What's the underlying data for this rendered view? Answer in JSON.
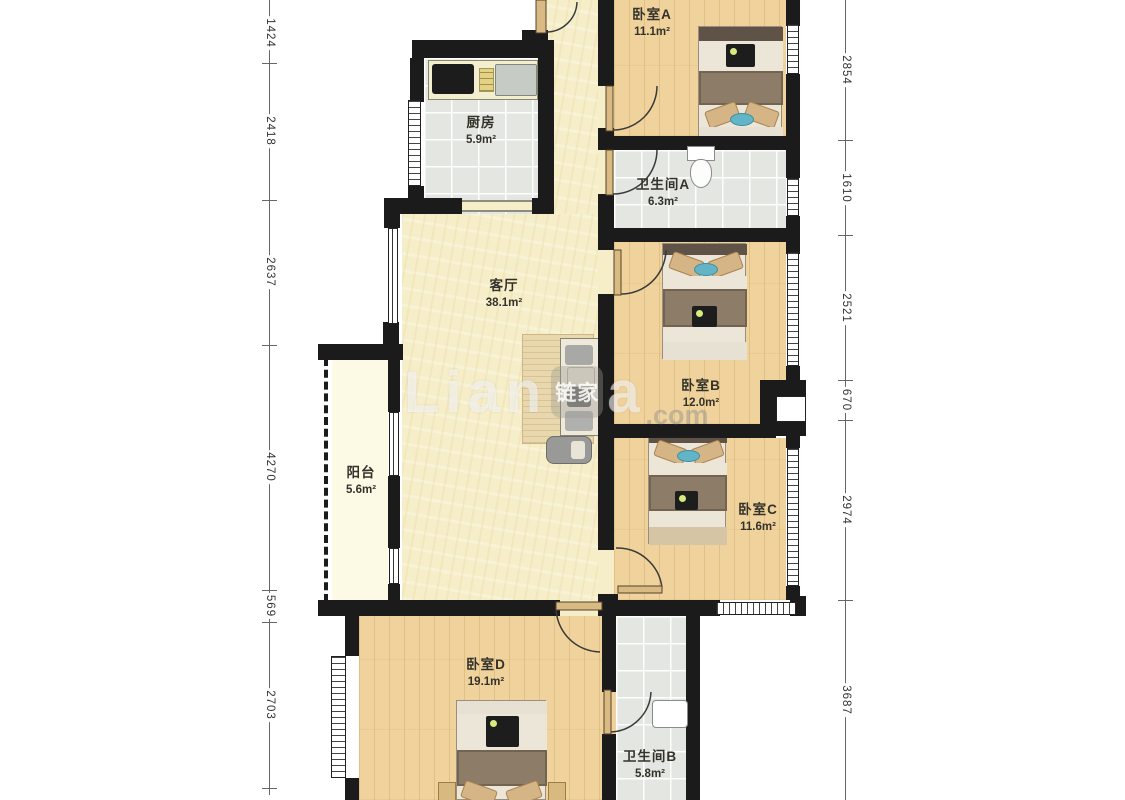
{
  "watermark": {
    "brand_left": "Lian",
    "logo": "链家",
    "brand_right": "a",
    "domain": ".com"
  },
  "rooms": {
    "bedroom_a": {
      "name": "卧室A",
      "area": "11.1m²"
    },
    "kitchen": {
      "name": "厨房",
      "area": "5.9m²"
    },
    "bathroom_a": {
      "name": "卫生间A",
      "area": "6.3m²"
    },
    "living_room": {
      "name": "客厅",
      "area": "38.1m²"
    },
    "bedroom_b": {
      "name": "卧室B",
      "area": "12.0m²"
    },
    "balcony": {
      "name": "阳台",
      "area": "5.6m²"
    },
    "bedroom_c": {
      "name": "卧室C",
      "area": "11.6m²"
    },
    "bedroom_d": {
      "name": "卧室D",
      "area": "19.1m²"
    },
    "bathroom_b": {
      "name": "卫生间B",
      "area": "5.8m²"
    }
  },
  "dimensions": {
    "left": [
      "1424",
      "2418",
      "2637",
      "4270",
      "569",
      "2703"
    ],
    "right": [
      "2854",
      "1610",
      "2521",
      "670",
      "2974",
      "3687"
    ]
  },
  "colors": {
    "wall": "#1b1b1b",
    "wood_floor": "#efd29c",
    "cream_floor": "#f6eec9",
    "tile_floor": "#e3e6e1",
    "balcony_floor": "#fcf9e4",
    "accent_blue": "#62b5c7"
  }
}
